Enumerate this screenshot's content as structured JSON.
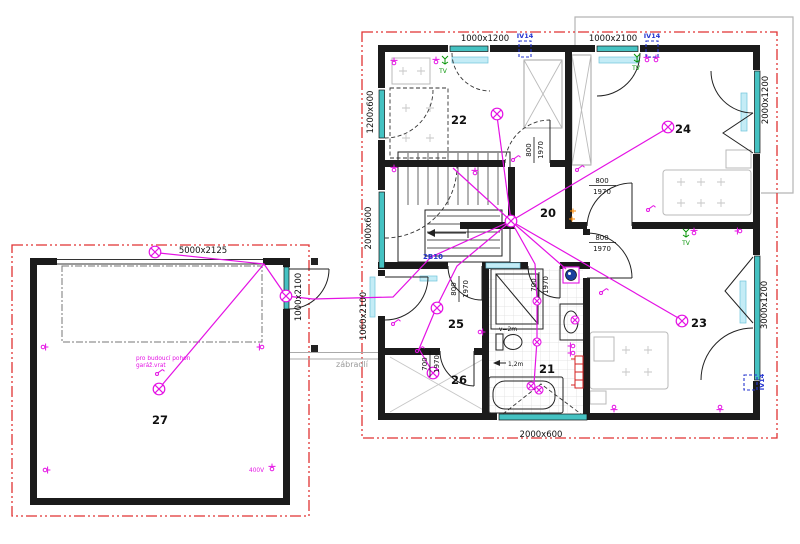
{
  "plan": {
    "rooms": {
      "r20": "20",
      "r21": "21",
      "r22": "22",
      "r23": "23",
      "r24": "24",
      "r25": "25",
      "r26": "26",
      "r27": "27"
    },
    "dimensions": {
      "win_top_left": "1000x1200",
      "win_top_right": "1000x2100",
      "win_left_upper": "1200x600",
      "win_left_lower": "2000x600",
      "win_right_upper": "2000x1200",
      "win_right_lower": "3000x1200",
      "win_bottom": "2000x600",
      "garage_door": "5000x2125",
      "garage_side_door": "1000x2100",
      "entry_door": "1060x2100"
    },
    "door_labels": {
      "w800": "800",
      "w700": "700",
      "h1970": "1970"
    },
    "annotations": {
      "iv14": "IV14",
      "tv": "TV",
      "circuit": "2B10",
      "shower_height": "v=2m",
      "tub_length": "1,2m",
      "railing": "zábradlí",
      "garage_note_line1": "pro budoucí pohon",
      "garage_note_line2": "garáž.vrat",
      "power": "400V"
    },
    "colors": {
      "wall": "#1b1b1b",
      "wire": "#e412e4",
      "boundary": "#e03232",
      "window": "#45c2c2",
      "lintel": "#c4ecf6",
      "circuit_blue": "#2635cf",
      "tv_green": "#089608",
      "orange": "#ff8a00",
      "radiator_red": "#d42222"
    }
  }
}
